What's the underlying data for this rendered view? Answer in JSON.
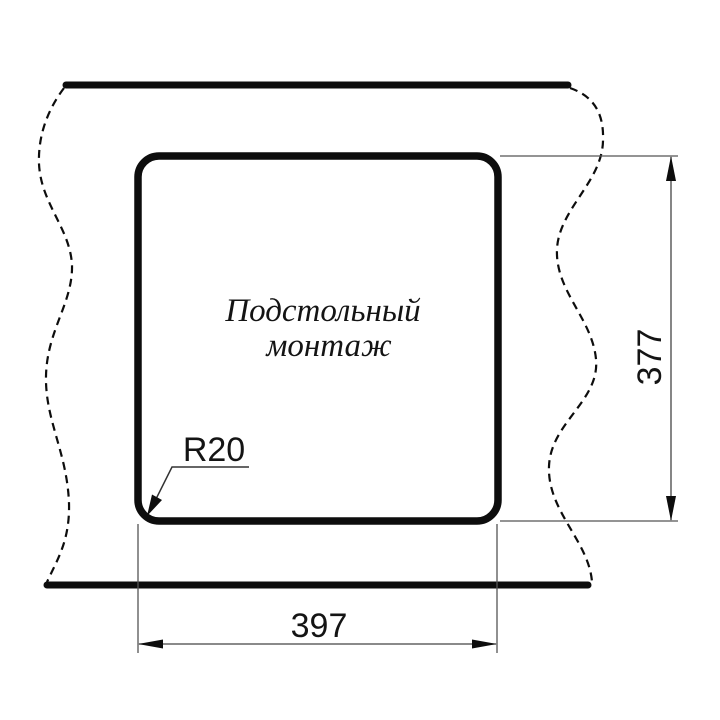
{
  "drawing": {
    "mounting_label": {
      "line1": "Подстольный",
      "line2": "монтаж",
      "full": "Подстольный монтаж"
    },
    "dimensions": {
      "cutout_width": "397",
      "cutout_height": "377",
      "corner_radius": "R20"
    },
    "colors": {
      "line": "#0d0d0d",
      "thin_line": "#555555",
      "text": "#141414",
      "background": "#ffffff"
    }
  }
}
